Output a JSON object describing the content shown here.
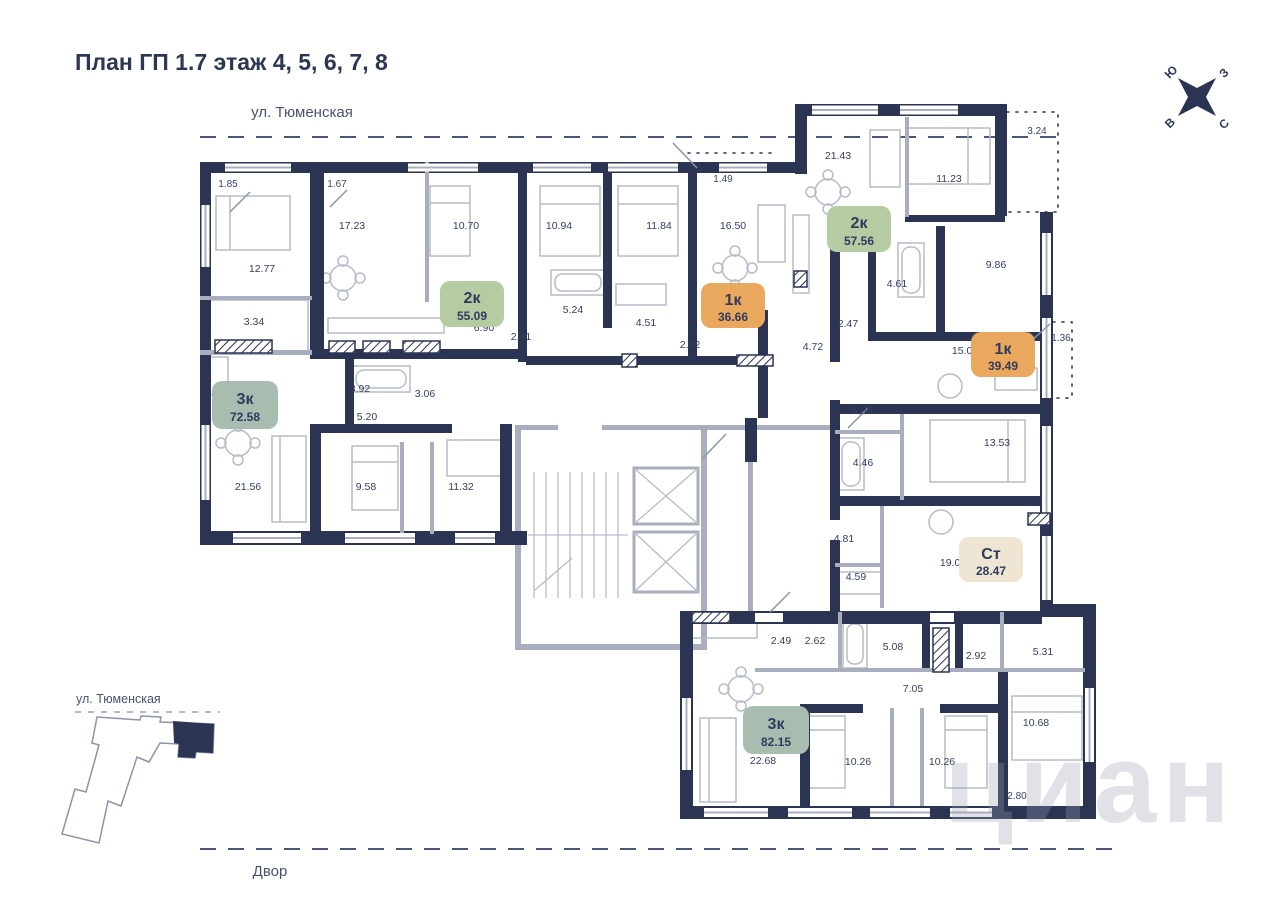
{
  "page": {
    "title": "План ГП 1.7 этаж 4, 5, 6, 7, 8"
  },
  "streets": {
    "top": "ул. Тюменская",
    "bottom": "Двор"
  },
  "minimap": {
    "street": "ул. Тюменская"
  },
  "compass": {
    "south": "Ю",
    "west": "З",
    "east": "В",
    "north": "С"
  },
  "watermark": "циан",
  "badges": [
    {
      "type": "3к",
      "area": "72.58",
      "color": "#a8bcb0"
    },
    {
      "type": "2к",
      "area": "55.09",
      "color": "#b5cba2"
    },
    {
      "type": "1к",
      "area": "36.66",
      "color": "#eaa75e"
    },
    {
      "type": "2к",
      "area": "57.56",
      "color": "#b5cba2"
    },
    {
      "type": "1к",
      "area": "39.49",
      "color": "#eaa75e"
    },
    {
      "type": "Ст",
      "area": "28.47",
      "color": "#eee6d3"
    },
    {
      "type": "3к",
      "area": "82.15",
      "color": "#a8bcb0"
    }
  ],
  "rooms": [
    "12.77",
    "17.23",
    "10.70",
    "10.94",
    "11.84",
    "16.50",
    "21.43",
    "11.23",
    "3.34",
    "6.90",
    "2.41",
    "5.24",
    "4.51",
    "2.32",
    "4.72",
    "2.47",
    "4.61",
    "9.86",
    "15.09",
    "3.92",
    "3.06",
    "5.20",
    "5.05",
    "4.46",
    "13.53",
    "21.56",
    "9.58",
    "11.32",
    "4.81",
    "4.59",
    "19.07",
    "2.49",
    "2.62",
    "5.08",
    "2.92",
    "5.31",
    "7.05",
    "22.68",
    "10.26",
    "10.26",
    "10.68"
  ],
  "dimensions": [
    "1.85",
    "1.67",
    "1.49",
    "3.24",
    "1.36",
    "2.80"
  ]
}
